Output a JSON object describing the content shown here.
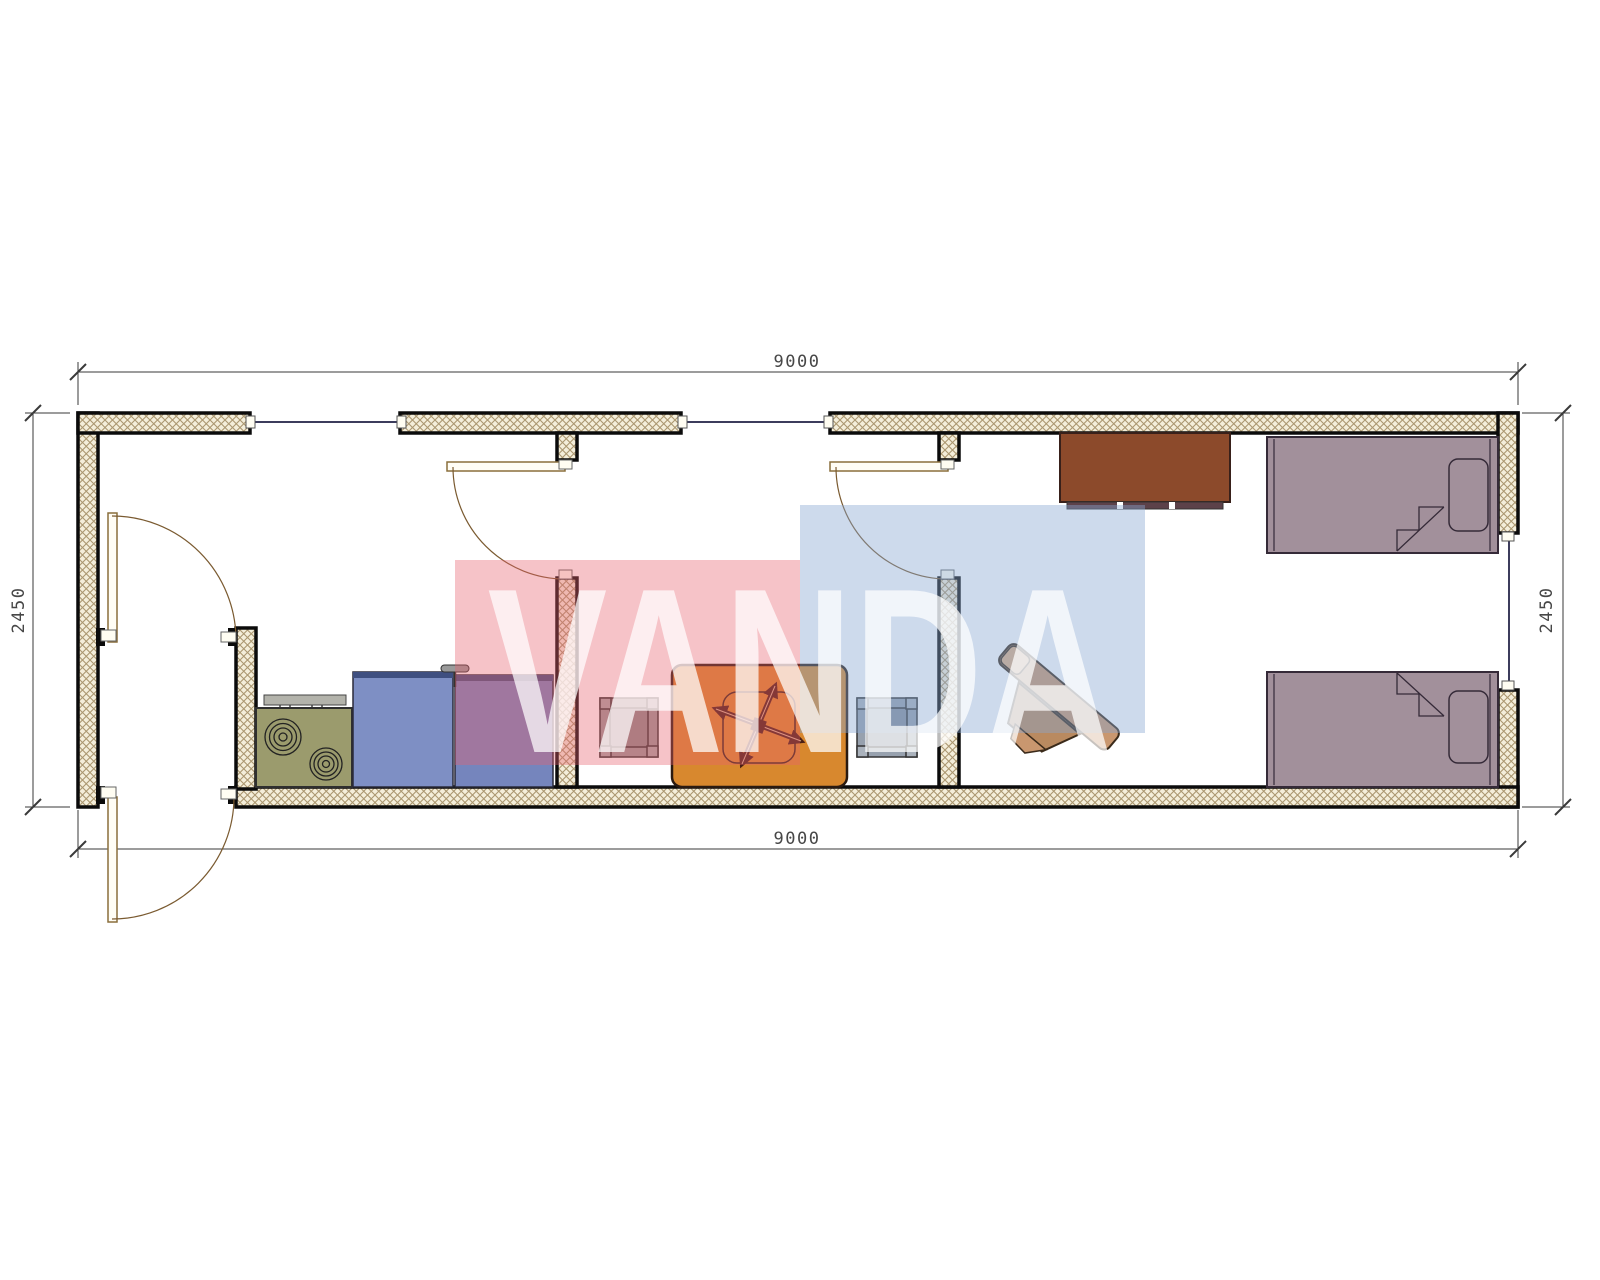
{
  "drawing": {
    "title": "container-house-floor-plan",
    "watermark_text": "VANDA",
    "dim_top": "9000",
    "dim_bottom": "9000",
    "dim_left": "2450",
    "dim_right": "2450"
  },
  "colors": {
    "wall_fill": "#f4eeda",
    "wall_hatch": "#ab9770",
    "outline": "#0b0b0b",
    "door": "#8a6f3c",
    "window_line": "#3c3c5c",
    "dim_text": "#474747",
    "watermark_red": "#e8606f",
    "watermark_blue": "#89a7d2",
    "watermark_letters": "#ffffff",
    "stove": "#9b9b6d",
    "stove_panel": "#b3b3ab",
    "cabinet_left": "#7e8fc4",
    "cabinet_right": "#7585bd",
    "counter_edge": "#3f4f80",
    "table": "#d8882e",
    "table_symbol": "#4a2015",
    "stool_left": "#9a9a9a",
    "stool_right": "#97a1ae",
    "dresser": "#8c4a2b",
    "dresser_base": "#5c4149",
    "chair": "#c9976f",
    "chair_dark": "#b98a60",
    "chair_light": "#dcae83",
    "bed": "#a2909b",
    "bed_outline": "#352a38"
  },
  "furniture": {
    "kitchen": [
      "stove-with-burners",
      "counter-cabinet",
      "sink-cabinet-with-faucet"
    ],
    "dining_room": [
      "square-stool-left",
      "dining-table-with-fan-symbol",
      "square-stool-right"
    ],
    "bedroom": [
      "dresser-cabinet",
      "desk-chair",
      "single-bed-top",
      "single-bed-bottom"
    ]
  }
}
